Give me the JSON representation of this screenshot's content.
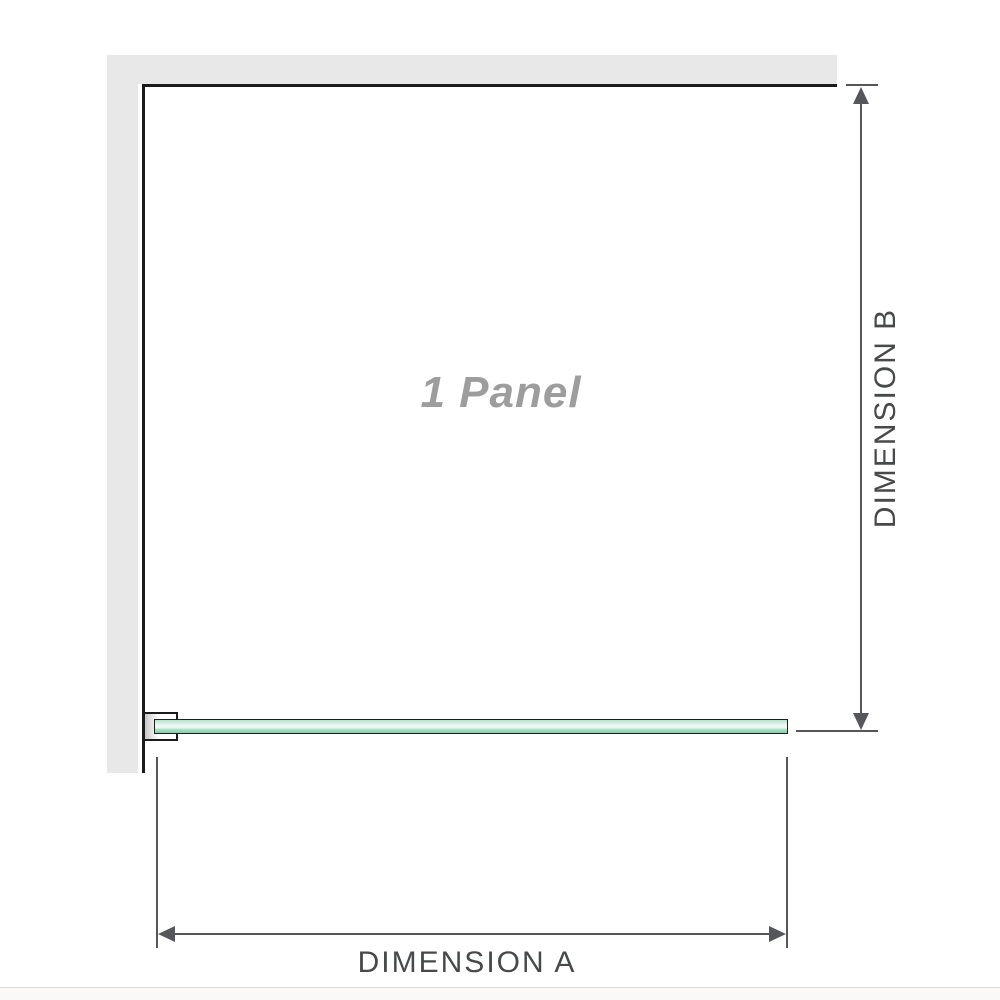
{
  "diagram": {
    "panel_label": "1 Panel",
    "dimension_a": {
      "label": "DIMENSION A"
    },
    "dimension_b": {
      "label": "DIMENSION B"
    }
  },
  "colors": {
    "background": "#ffffff",
    "wall": "#e8e8e8",
    "outline": "#1b1b1b",
    "dimension-line": "#55575a",
    "dimension-label": "#47494b",
    "panel-label": "#9d9d9d",
    "glass-border": "#1f201f",
    "glass-top": "#b2e3cb",
    "glass-mid": "#ecf8f2",
    "glass-low": "#a7dec2",
    "glass-bottom": "#82cfa6",
    "bracket-fill": "#ffffff",
    "bracket-shadow": "#c8c8c8",
    "divider": "#dcdcdc",
    "footer-strip": "#faf9f7"
  }
}
